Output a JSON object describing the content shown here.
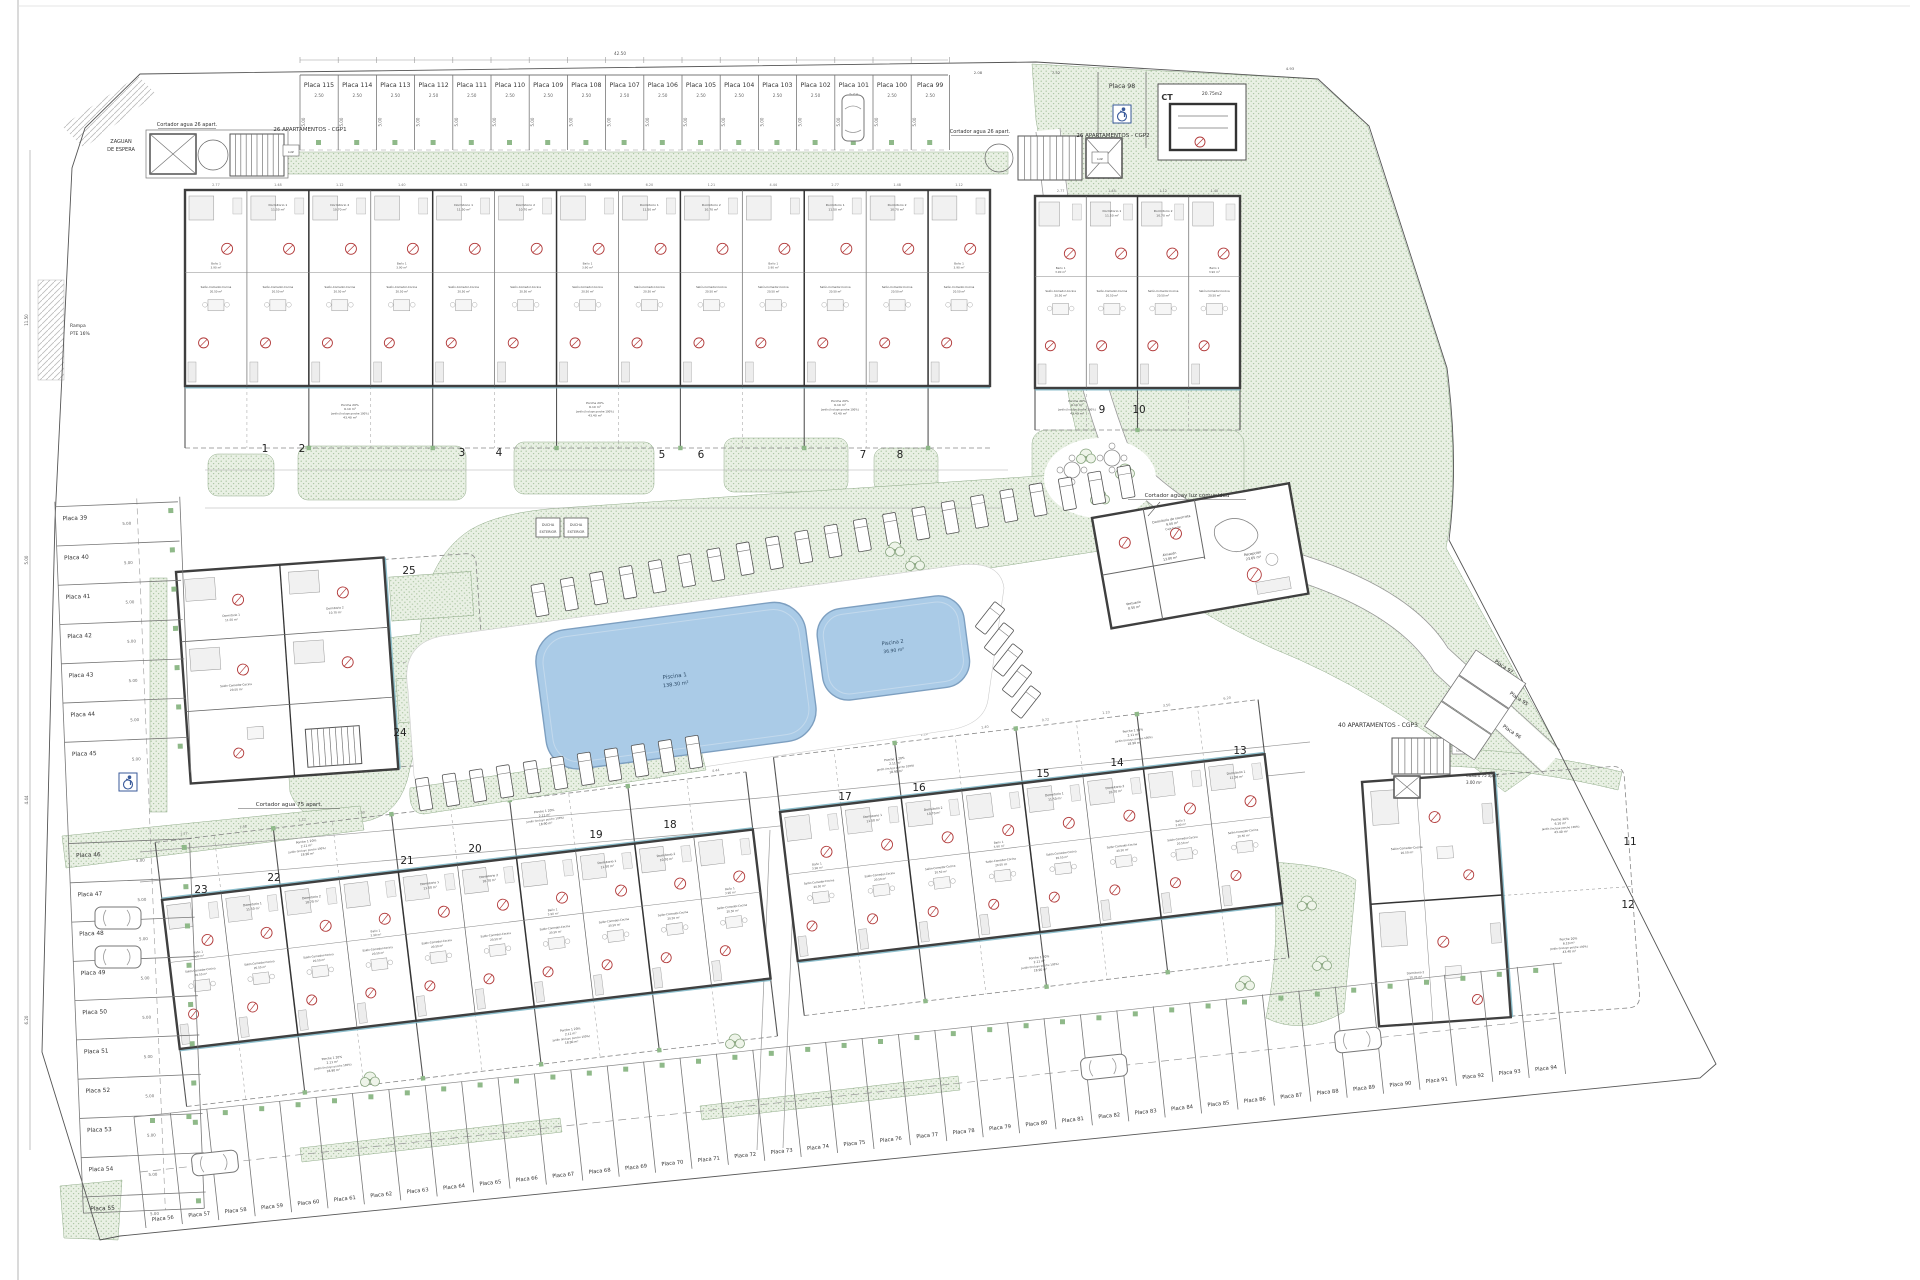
{
  "drawing": {
    "zaguan_line1": "ZAGUAN",
    "zaguan_line2": "DE ESPERA",
    "rampa_line1": "Rampa",
    "rampa_line2": "PTE 16%",
    "cgp1": "26 APARTAMENTOS - CGP1",
    "cgp2": "26 APARTAMENTOS - CGP2",
    "cgp3": "40 APARTAMENTOS - CGP3",
    "cortador26": "Cortador agua 26 apart.",
    "cortador75": "Cortador agua 75 apart.",
    "cortador_comunidad": "Cortador aguay luz comunidad",
    "cuadro75_line1": "Cuadro 75 apart.",
    "cuadro75_line2": "3.00 m²",
    "ct": "CT",
    "ct_area": "20.75m2",
    "luz": "LUZ",
    "ducha_line1": "DUCHA",
    "ducha_line2": "EXTERIOR"
  },
  "pools": [
    {
      "name": "Piscina 1",
      "area": "138.30 m²"
    },
    {
      "name": "Piscina 2",
      "area": "36.90 m²"
    }
  ],
  "units": {
    "blockA": [
      "1",
      "2",
      "3",
      "4",
      "5",
      "6",
      "7",
      "8"
    ],
    "blockB": [
      "9",
      "10"
    ],
    "blockC": [
      "23",
      "22",
      "21",
      "20",
      "19",
      "18"
    ],
    "blockD": [
      "17",
      "16",
      "15",
      "14",
      "13"
    ],
    "blockE": [
      "11",
      "12"
    ],
    "left_small": [
      "25",
      "24"
    ]
  },
  "parking": {
    "top": [
      "Placa 115",
      "Placa 114",
      "Placa 113",
      "Placa 112",
      "Placa 111",
      "Placa 110",
      "Placa 109",
      "Placa 108",
      "Placa 107",
      "Placa 106",
      "Placa 105",
      "Placa 104",
      "Placa 103",
      "Placa 102",
      "Placa 101",
      "Placa 100",
      "Placa 99"
    ],
    "accessible": "Placa 98",
    "left": [
      "Placa 39",
      "Placa 40",
      "Placa 41",
      "Placa 42",
      "Placa 43",
      "Placa 44",
      "Placa 45",
      "Placa 46",
      "Placa 47",
      "Placa 48",
      "Placa 49",
      "Placa 50",
      "Placa 51",
      "Placa 52",
      "Placa 53",
      "Placa 54",
      "Placa 55"
    ],
    "bottom": [
      "Placa 56",
      "Placa 57",
      "Placa 58",
      "Placa 59",
      "Placa 60",
      "Placa 61",
      "Placa 62",
      "Placa 63",
      "Placa 64",
      "Placa 65",
      "Placa 66",
      "Placa 67",
      "Placa 68",
      "Placa 69",
      "Placa 70",
      "Placa 71",
      "Placa 72",
      "Placa 73",
      "Placa 74",
      "Placa 75",
      "Placa 76",
      "Placa 77",
      "Placa 78",
      "Placa 79",
      "Placa 80",
      "Placa 81",
      "Placa 82",
      "Placa 83",
      "Placa 84",
      "Placa 85",
      "Placa 86",
      "Placa 87",
      "Placa 88",
      "Placa 89",
      "Placa 90",
      "Placa 91",
      "Placa 92",
      "Placa 93",
      "Placa 94"
    ],
    "right": [
      "Placa 97",
      "Placa 95",
      "Placa 96"
    ],
    "width_dim": "2.50",
    "depth_dim": "5.00"
  },
  "communal": {
    "reception": "Recepción",
    "reception_area": "23.65 m²",
    "socorrista": "Dormitorio de socorrista",
    "socorrista_area": "9.00 m²",
    "caja": "Caja fuerte",
    "almacen": "Almacén",
    "almacen_area": "13.80 m²",
    "vestuario": "Vestuario",
    "vestuario_area": "8.50 m²"
  },
  "rooms": {
    "dorm1": "Dormitorio 1",
    "dorm1_area": "11.50 m²",
    "dorm2": "Dormitorio 2",
    "dorm2_area": "10.70 m²",
    "salon": "Salón-Comedor-Cocina",
    "salon_area": "20.50 m²",
    "bano1": "Baño 1",
    "bano1_area": "3.90 m²",
    "bano2": "Baño 2",
    "bano2_area": "3.00 m²",
    "paso": "Paso",
    "paso_area": "4.60 m²"
  },
  "garden": {
    "porche": "Porche 20%",
    "porche_area": "6.10 m²",
    "porche1": "Porche 1 20%",
    "porche1_area": "2.11 m²",
    "jardin": "Jardín (Incluye porche 100%)",
    "jardin_area": "43.40 m²",
    "jardin_area2": "18.90 m²"
  },
  "dims": [
    "2.77",
    "1.48",
    "1.12",
    "1.40",
    "0.72",
    "1.10",
    "3.50",
    "6.20",
    "1.21",
    "4.44",
    "2.50",
    "5.00",
    "8.37",
    "11.50",
    "42.50",
    "2.08",
    "7.52",
    "4.93"
  ]
}
